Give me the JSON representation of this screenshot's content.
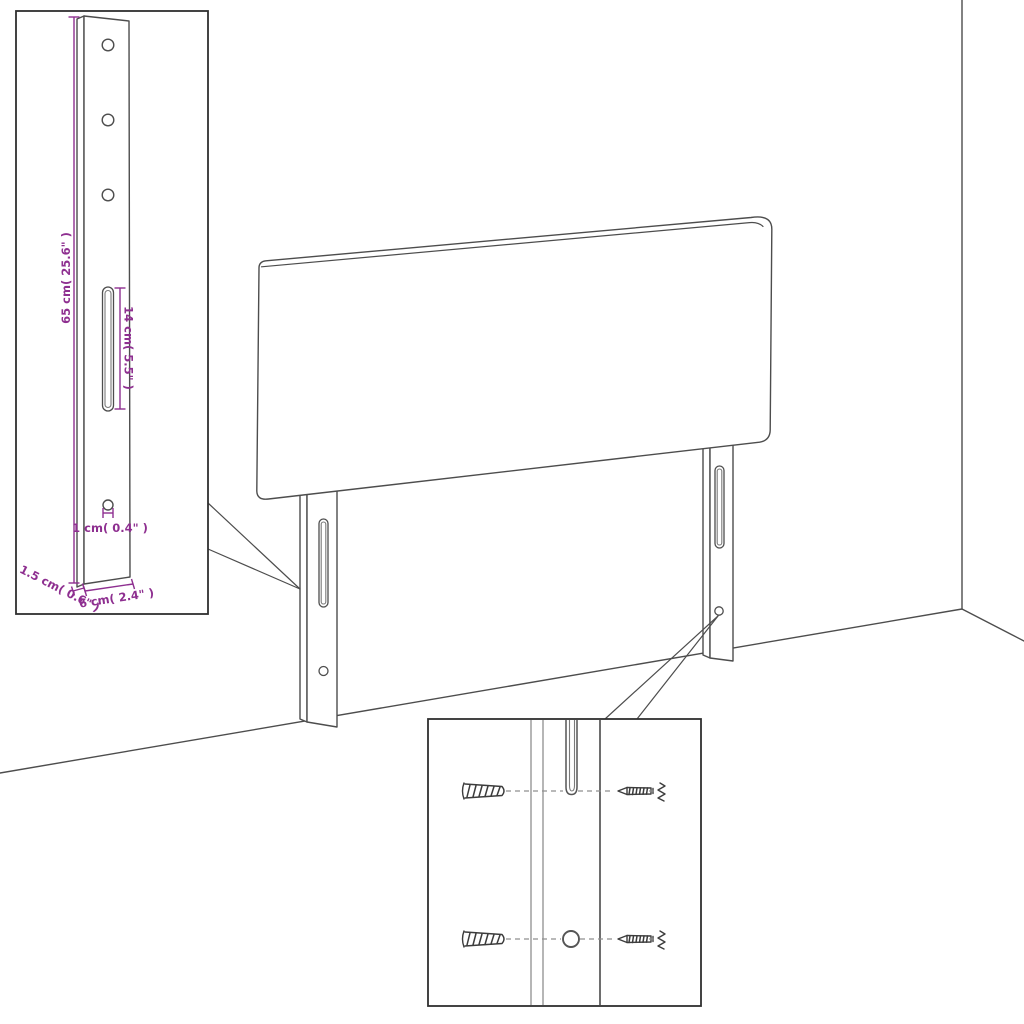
{
  "diagram": {
    "kind": "furniture-dimension-diagram",
    "subject": "upholstered headboard with two slotted mounting legs, wall-corner backdrop, magnified detail insets",
    "colors": {
      "background": "#ffffff",
      "line": "#4d4d4d",
      "inset_border": "#2f2f2f",
      "dimension_accent": "#8e2f90"
    },
    "bracket_inset": {
      "dim_height": "65 cm( 25.6\" )",
      "dim_slot_length": "14 cm( 5.5\" )",
      "dim_hole": "1 cm( 0.4\" )",
      "dim_thickness": "1.5 cm( 0.6\" )",
      "dim_width": "6 cm( 2.4\" )"
    },
    "hardware_inset": {
      "wall_plug_count": 2,
      "screw_count": 2
    }
  }
}
